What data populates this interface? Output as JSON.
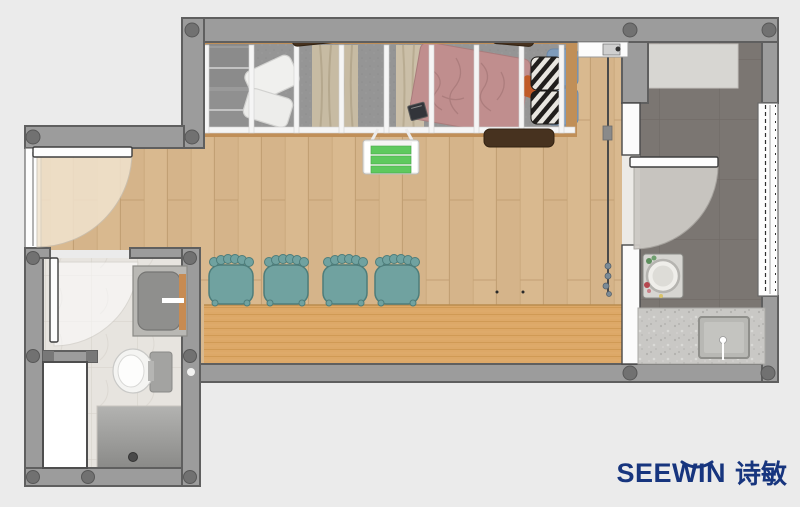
{
  "brand": {
    "wordmark": "SEEWIN",
    "cjk_name": "诗敏",
    "logo_color": "#17357e"
  },
  "palette": {
    "background": "#ebebeb",
    "wall_fill": "#9c9c9c",
    "wall_outline": "#5f5f5f",
    "rivet": "#717171",
    "wood_floor": "#d9b98f",
    "platform_wood": "#dda867",
    "loft_carpet": "#959595",
    "loft_frame_wood": "#c08f58",
    "kitchen_floor": "#7b7672",
    "kitchen_mat": "#d7d6d2",
    "counter_terrazzo": "#c9c8c5",
    "bathroom_marble": "#e7e4df",
    "shower_floor": "#9e9e9c",
    "stool_teal": "#70a2a0",
    "stool_outline": "#4d7d7b",
    "bed_blanket_rose": "#c08e8e",
    "pillow_blue": "#7f9cbb",
    "ladder_step_green": "#5ec95e",
    "accent_wood_orange": "#c78b52",
    "dark_wood_slab": "#47321f",
    "door_leaf": "#fdfdfd"
  },
  "fixtures": [
    "loft-bed",
    "bed-blanket",
    "zebra-cushions",
    "blue-pillows",
    "wardrobe-shelf",
    "throw-pillows",
    "curtains",
    "hanging-ladder",
    "dining-stools",
    "raised-platform",
    "entry-door",
    "bathroom-door",
    "kitchen-door",
    "vanity-sink",
    "toilet",
    "shower",
    "storage-cabinet",
    "round-wash-basin",
    "kitchen-counter-sink",
    "window-wall",
    "sliding-door-track",
    "shoe-shelf"
  ]
}
